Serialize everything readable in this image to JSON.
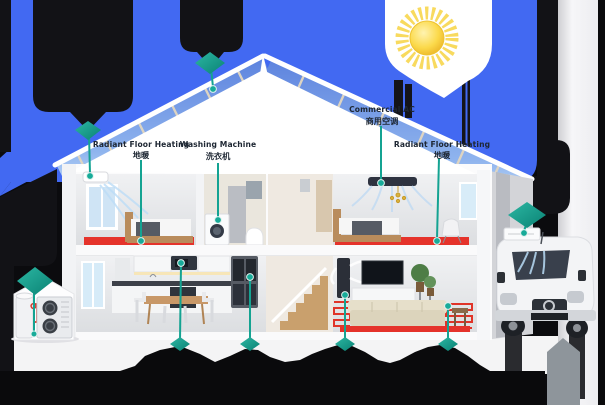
{
  "diagram": {
    "description": "Cutaway smart-home energy infographic with solar roof, heat pump, appliances, delivery van and callout markers",
    "colors": {
      "sky_blue": "#4269f2",
      "void_black": "#0b0b0e",
      "teal_accent": "#14a392",
      "floor_heating_red": "#e5332b",
      "sun_yellow": "#f2c832",
      "panel_blue": "#6f93e6",
      "side_panel_white": "#f4f4f6"
    },
    "labels": [
      {
        "id": "radiant-floor-heating-left",
        "en": "Radiant Floor Heating",
        "zh": "地暖"
      },
      {
        "id": "washing-machine",
        "en": "Washing Machine",
        "zh": "洗衣机"
      },
      {
        "id": "commercial-ac",
        "en": "Commercial AC",
        "zh": "商用空调"
      },
      {
        "id": "radiant-floor-heating-right",
        "en": "Radiant Floor Heating",
        "zh": "地暖"
      }
    ],
    "markers": [
      {
        "icon": "diamond-marker",
        "target": "wall-ac-unit"
      },
      {
        "icon": "diamond-marker",
        "target": "solar-roof"
      },
      {
        "icon": "diamond-marker",
        "target": "heat-pump-outdoor-unit"
      },
      {
        "icon": "diamond-marker",
        "target": "van-roof-ac"
      },
      {
        "icon": "diamond-marker",
        "target": "microwave"
      },
      {
        "icon": "diamond-marker",
        "target": "refrigerator"
      },
      {
        "icon": "diamond-marker",
        "target": "floor-standing-ac"
      },
      {
        "icon": "diamond-marker",
        "target": "living-room-floor-heating"
      }
    ]
  }
}
